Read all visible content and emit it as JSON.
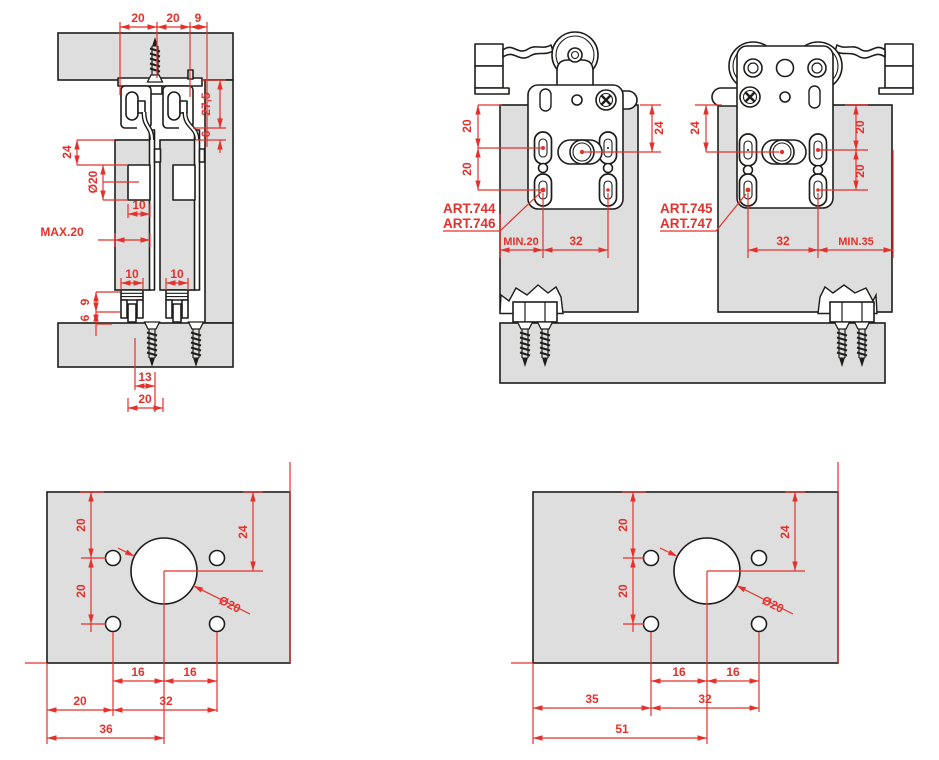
{
  "colors": {
    "dimension_red": "#e5312b",
    "panel_gray": "#dedede",
    "outline_black": "#1d1d1b",
    "background": "#ffffff"
  },
  "section_view": {
    "top_dims": [
      "20",
      "20",
      "9"
    ],
    "track_height": "27,5",
    "track_clearance": "6",
    "hole_top_offset": "24",
    "hole_diameter": "Ø20",
    "hole_depth": "10",
    "door_thickness_max": "MAX.20",
    "guide_width_dims": [
      "10",
      "10"
    ],
    "guide_height": "9",
    "guide_inset": "6",
    "floor_dims": [
      "13",
      "20"
    ]
  },
  "carriage_view": {
    "left": {
      "articles": [
        "ART.744",
        "ART.746"
      ],
      "side_dims": [
        "20",
        "20"
      ],
      "center_dim": "24",
      "bottom_dims": [
        "MIN.20",
        "32"
      ]
    },
    "right": {
      "articles": [
        "ART.745",
        "ART.747"
      ],
      "center_dim": "24",
      "side_dims": [
        "20",
        "20"
      ],
      "bottom_dims": [
        "32",
        "MIN.35"
      ]
    }
  },
  "drill_template_left": {
    "vertical_dims": [
      "20",
      "20"
    ],
    "center_offset": "24",
    "hole_diameter": "Ø20",
    "hole_spacing": [
      "16",
      "16"
    ],
    "bottom_dims": [
      "20",
      "32",
      "36"
    ]
  },
  "drill_template_right": {
    "vertical_dims": [
      "20",
      "20"
    ],
    "center_offset": "24",
    "hole_diameter": "Ø20",
    "hole_spacing": [
      "16",
      "16"
    ],
    "bottom_dims": [
      "35",
      "32",
      "51"
    ]
  }
}
